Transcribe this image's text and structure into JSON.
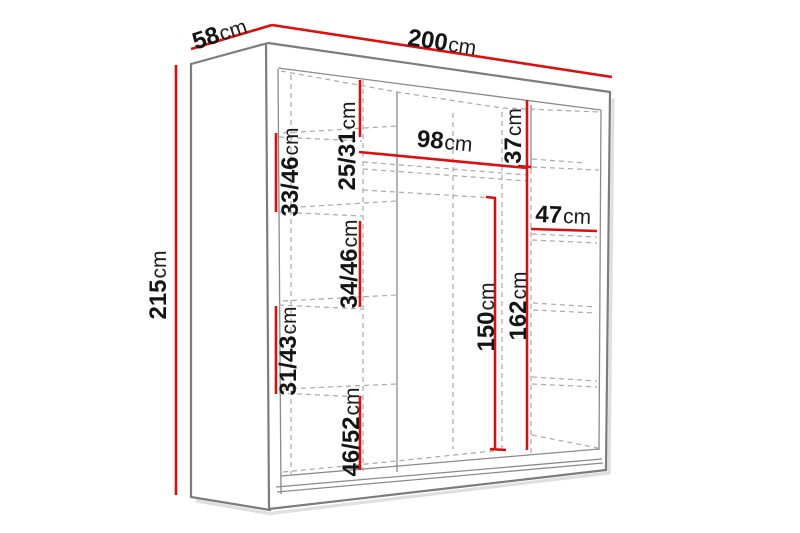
{
  "diagram_title": "wardrobe-dimension-diagram",
  "unit": "cm",
  "colors": {
    "measurement_line": "#dc0e0e",
    "cabinet_outline": "#7c7c7c",
    "hidden_edges": "#a9a9a9",
    "label_text": "#141414",
    "background": "#ffffff"
  },
  "dimensions": {
    "depth": {
      "value": "58",
      "unit": "cm"
    },
    "width": {
      "value": "200",
      "unit": "cm"
    },
    "height": {
      "value": "215",
      "unit": "cm"
    },
    "left_top_gap": {
      "value": "25/31",
      "unit": "cm"
    },
    "left_gap_1": {
      "value": "33/46",
      "unit": "cm"
    },
    "middle_width": {
      "value": "98",
      "unit": "cm"
    },
    "right_top_gap": {
      "value": "37",
      "unit": "cm"
    },
    "right_width": {
      "value": "47",
      "unit": "cm"
    },
    "left_gap_2": {
      "value": "34/46",
      "unit": "cm"
    },
    "rail_height": {
      "value": "150",
      "unit": "cm"
    },
    "middle_height": {
      "value": "162",
      "unit": "cm"
    },
    "left_gap_3": {
      "value": "31/43",
      "unit": "cm"
    },
    "left_bottom_gap": {
      "value": "46/52",
      "unit": "cm"
    }
  }
}
